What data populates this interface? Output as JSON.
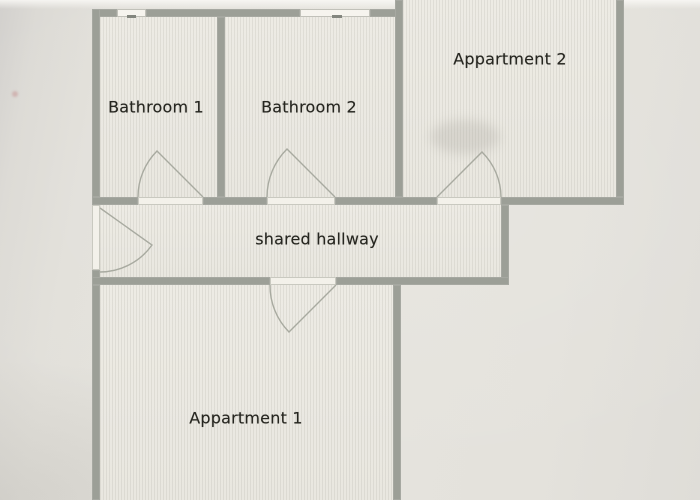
{
  "floor_plan": {
    "rooms": [
      {
        "name": "bathroom-1",
        "label": "Bathroom 1"
      },
      {
        "name": "bathroom-2",
        "label": "Bathroom 2"
      },
      {
        "name": "appartment-2",
        "label": "Appartment 2"
      },
      {
        "name": "shared-hallway",
        "label": "shared hallway"
      },
      {
        "name": "appartment-1",
        "label": "Appartment 1"
      }
    ],
    "features": {
      "doors": 5,
      "windows": 2
    },
    "colors": {
      "wall": "#9c9f97",
      "floor": "#ecebe3",
      "background": "#e3e1db",
      "door_threshold": "#f3f1ea",
      "door_arc": "#a8aaa0",
      "label_text": "#262620"
    }
  }
}
